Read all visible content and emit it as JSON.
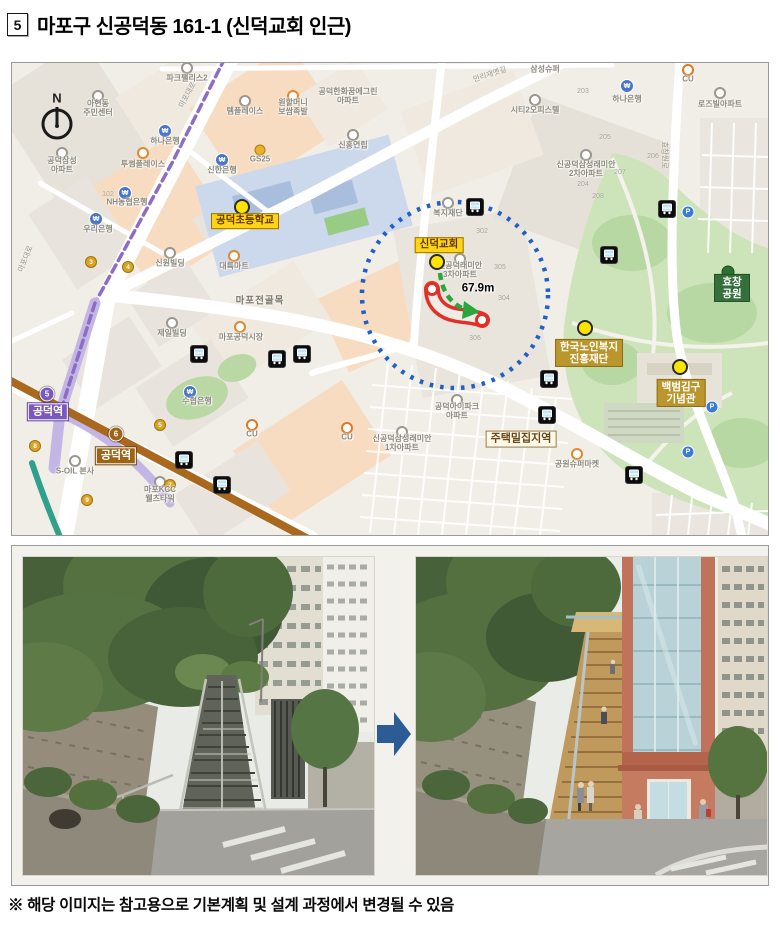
{
  "page": {
    "item_number": "5",
    "title": "마포구 신공덕동 161-1 (신덕교회 인근)",
    "footnote": "※ 해당 이미지는 참고용으로 기본계획 및 설계 과정에서 변경될 수 있음"
  },
  "map": {
    "compass_label": "N",
    "distance_label": "67.9m",
    "distance_pos": [
      466,
      226
    ],
    "colors": {
      "park": "#cde3ba",
      "line5": "#8d6cc4",
      "line6": "#a9681e",
      "radius_circle": "#1f5fc8",
      "route_outline": "#e03028",
      "route_arrow": "#27a73c"
    },
    "major_pois": [
      {
        "id": "gongdeok-elementary",
        "text": "공덕초등학교",
        "style": "yellow",
        "x": 233,
        "y": 158,
        "dot": "yellow",
        "dx": 230,
        "dy": 144
      },
      {
        "id": "sindeok-church",
        "text": "신덕교회",
        "style": "yellow",
        "x": 427,
        "y": 182,
        "dot": "yellow",
        "dx": 425,
        "dy": 199
      },
      {
        "id": "hyochang-park",
        "text": "효창공원",
        "style": "green",
        "x": 720,
        "y": 225,
        "dot": "green",
        "dx": 716,
        "dy": 209
      },
      {
        "id": "korea-senior-welfare-foundation",
        "text": "한국노인복지\n진흥재단",
        "style": "gold",
        "x": 577,
        "y": 290,
        "dot": "yellow",
        "dx": 573,
        "dy": 265
      },
      {
        "id": "kim-koo-museum",
        "text": "백범김구\n기념관",
        "style": "gold",
        "x": 669,
        "y": 330,
        "dot": "yellow",
        "dx": 668,
        "dy": 304
      },
      {
        "id": "dense-housing-area",
        "text": "주택밀집지역",
        "style": "cream",
        "x": 509,
        "y": 376
      },
      {
        "id": "gongdeok-station-line5",
        "text": "공덕역",
        "style": "purple",
        "x": 36,
        "y": 349
      },
      {
        "id": "gongdeok-station-line6",
        "text": "공덕역",
        "style": "brown",
        "x": 104,
        "y": 393
      }
    ],
    "minor_labels": [
      {
        "text": "아현동\n주민센터",
        "x": 86,
        "y": 45
      },
      {
        "text": "파크팰리스2",
        "x": 175,
        "y": 15
      },
      {
        "text": "템플레이스",
        "x": 233,
        "y": 48
      },
      {
        "text": "원할머니\n보쌈족발",
        "x": 281,
        "y": 44
      },
      {
        "text": "공덕한화꿈에그린\n아파트",
        "x": 336,
        "y": 33
      },
      {
        "text": "삼성슈퍼",
        "x": 533,
        "y": 6
      },
      {
        "text": "CU",
        "x": 676,
        "y": 16
      },
      {
        "text": "하나은행",
        "x": 153,
        "y": 78
      },
      {
        "text": "신한은행",
        "x": 210,
        "y": 107
      },
      {
        "text": "NH농협은행",
        "x": 115,
        "y": 139
      },
      {
        "text": "우리은행",
        "x": 86,
        "y": 166
      },
      {
        "text": "투썸플레이스",
        "x": 131,
        "y": 101
      },
      {
        "text": "공덕삼성\n아파트",
        "x": 50,
        "y": 102
      },
      {
        "text": "신흥연립",
        "x": 341,
        "y": 82
      },
      {
        "text": "GS25",
        "x": 248,
        "y": 96
      },
      {
        "text": "하나은행",
        "x": 615,
        "y": 36
      },
      {
        "text": "로즈빌아파트",
        "x": 708,
        "y": 41
      },
      {
        "text": "신공덕삼성래미안\n2차아파트",
        "x": 574,
        "y": 106
      },
      {
        "text": "복지재단",
        "x": 436,
        "y": 150
      },
      {
        "text": "신공덕래미안\n3차아파트",
        "x": 448,
        "y": 207
      },
      {
        "text": "공덕아이파크\n아파트",
        "x": 445,
        "y": 348
      },
      {
        "text": "신공덕삼성래미안\n1차아파트",
        "x": 390,
        "y": 380
      },
      {
        "text": "제일빌딩",
        "x": 160,
        "y": 270
      },
      {
        "text": "마포공덕시장",
        "x": 229,
        "y": 274
      },
      {
        "text": "수협은행",
        "x": 185,
        "y": 338
      },
      {
        "text": "신원빌딩",
        "x": 158,
        "y": 200
      },
      {
        "text": "대륙마트",
        "x": 222,
        "y": 203
      },
      {
        "text": "S-OIL 본사",
        "x": 63,
        "y": 408
      },
      {
        "text": "마포KCC\n웰츠타워",
        "x": 148,
        "y": 431
      },
      {
        "text": "CU",
        "x": 240,
        "y": 371
      },
      {
        "text": "CU",
        "x": 335,
        "y": 374
      },
      {
        "text": "공원슈퍼마켓",
        "x": 565,
        "y": 401
      },
      {
        "text": "시티2오피스텔",
        "x": 523,
        "y": 47
      }
    ],
    "area_labels": [
      {
        "text": "마포전골목",
        "x": 248,
        "y": 239
      }
    ],
    "road_labels": [
      {
        "text": "마포대로",
        "x": 176,
        "y": 32,
        "rot": -62
      },
      {
        "text": "마포대로",
        "x": 14,
        "y": 196,
        "rot": -68
      },
      {
        "text": "만리재옛길",
        "x": 478,
        "y": 12,
        "rot": -18
      },
      {
        "text": "효창원로",
        "x": 652,
        "y": 92,
        "rot": 90
      }
    ],
    "block_numbers": [
      {
        "text": "102",
        "x": 96,
        "y": 132
      },
      {
        "text": "302",
        "x": 470,
        "y": 169
      },
      {
        "text": "305",
        "x": 488,
        "y": 205
      },
      {
        "text": "304",
        "x": 492,
        "y": 236
      },
      {
        "text": "306",
        "x": 463,
        "y": 276
      },
      {
        "text": "203",
        "x": 571,
        "y": 29
      },
      {
        "text": "205",
        "x": 593,
        "y": 75
      },
      {
        "text": "206",
        "x": 641,
        "y": 94
      },
      {
        "text": "207",
        "x": 608,
        "y": 110
      },
      {
        "text": "204",
        "x": 571,
        "y": 122
      },
      {
        "text": "208",
        "x": 586,
        "y": 134
      }
    ],
    "bus_stops": [
      [
        463,
        144
      ],
      [
        655,
        146
      ],
      [
        597,
        192
      ],
      [
        187,
        291
      ],
      [
        265,
        296
      ],
      [
        290,
        291
      ],
      [
        172,
        397
      ],
      [
        210,
        422
      ],
      [
        537,
        316
      ],
      [
        535,
        352
      ],
      [
        622,
        412
      ]
    ],
    "exit_badges": [
      {
        "n": "3",
        "x": 79,
        "y": 199
      },
      {
        "n": "4",
        "x": 116,
        "y": 204
      },
      {
        "n": "8",
        "x": 23,
        "y": 383
      },
      {
        "n": "5",
        "x": 148,
        "y": 362
      },
      {
        "n": "7",
        "x": 158,
        "y": 422
      },
      {
        "n": "9",
        "x": 75,
        "y": 437
      }
    ],
    "line_badges": [
      {
        "n": "5",
        "x": 35,
        "y": 331,
        "color": "#7b58c0"
      },
      {
        "n": "6",
        "x": 104,
        "y": 371,
        "color": "#9c6414"
      }
    ],
    "bank_icons": [
      [
        153,
        68
      ],
      [
        210,
        97
      ],
      [
        113,
        130
      ],
      [
        84,
        156
      ],
      [
        178,
        329
      ],
      [
        615,
        23
      ]
    ],
    "parking_icons": [
      [
        700,
        344
      ],
      [
        676,
        389
      ],
      [
        676,
        149
      ]
    ],
    "rings": [
      [
        50,
        90
      ],
      [
        86,
        33
      ],
      [
        175,
        5
      ],
      [
        233,
        38
      ],
      [
        341,
        72
      ],
      [
        158,
        190
      ],
      [
        574,
        92
      ],
      [
        448,
        196
      ],
      [
        445,
        337
      ],
      [
        390,
        369
      ],
      [
        708,
        30
      ],
      [
        523,
        37
      ],
      [
        160,
        260
      ],
      [
        148,
        419
      ],
      [
        63,
        398
      ],
      [
        436,
        140
      ]
    ],
    "orange_rings": [
      [
        222,
        193
      ],
      [
        228,
        264
      ],
      [
        565,
        391
      ],
      [
        281,
        33
      ],
      [
        131,
        90
      ]
    ],
    "cu_dots": [
      [
        676,
        7
      ],
      [
        240,
        362
      ],
      [
        335,
        365
      ]
    ],
    "gs_dots": [
      [
        248,
        87
      ]
    ]
  },
  "photos": {
    "arrow_color": "#2b5c94"
  }
}
